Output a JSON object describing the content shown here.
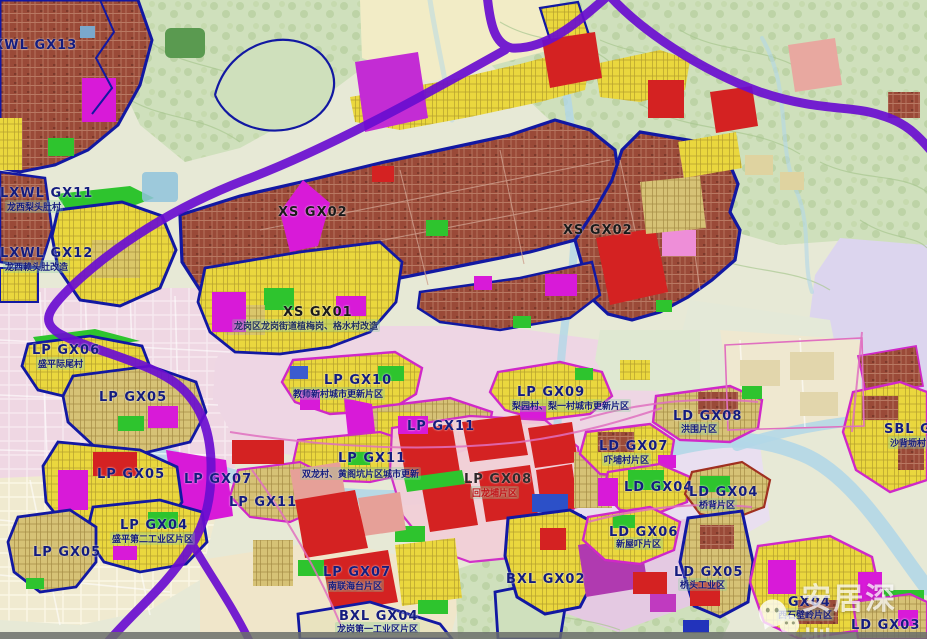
{
  "watermark": {
    "brand": "安居深圳",
    "icon": "wechat-icon"
  },
  "colors": {
    "boundary_purple": "#6a0dd0",
    "boundary_navy": "#1218a2",
    "boundary_magenta": "#d028c8",
    "urban_brown": "#9a4a38",
    "zone_yellow": "#ead73e",
    "zone_khaki": "#d6c276",
    "zone_red": "#d42222",
    "zone_green": "#2ec42e",
    "zone_magenta": "#d81ad8",
    "water_blue": "#b2d7e7",
    "hill_green": "#cfe0bc",
    "label_navy": "#141c7e"
  },
  "labels": [
    {
      "code": "LXWL GX13",
      "x": -16,
      "y": 36
    },
    {
      "code": "LXWL GX11",
      "x": 0,
      "y": 184,
      "sub": "龙西梨头肚村",
      "sx": 5,
      "sy": 200
    },
    {
      "code": "LXWL GX12",
      "x": 0,
      "y": 244,
      "sub": "龙西赖头肚改造",
      "sx": 3,
      "sy": 260
    },
    {
      "code": "XS GX02",
      "x": 278,
      "y": 203,
      "color": "#1a1a1a"
    },
    {
      "code": "XS GX01",
      "x": 283,
      "y": 303,
      "color": "#1a1a1a",
      "sub": "龙岗区龙岗街道植梅岗、格水村改造",
      "sx": 232,
      "sy": 319,
      "subColor": "#203060"
    },
    {
      "code": "XS GX02",
      "x": 563,
      "y": 221,
      "color": "#1a1a1a"
    },
    {
      "code": "LP GX06",
      "x": 32,
      "y": 341,
      "sub": "盛平际尾村",
      "sx": 36,
      "sy": 357
    },
    {
      "code": "LP GX05",
      "x": 99,
      "y": 388
    },
    {
      "code": "LP GX05",
      "x": 97,
      "y": 465
    },
    {
      "code": "LP GX04",
      "x": 120,
      "y": 516,
      "sub": "盛平第二工业区片区",
      "sx": 110,
      "sy": 532
    },
    {
      "code": "LP GX05",
      "x": 33,
      "y": 543
    },
    {
      "code": "LP GX10",
      "x": 324,
      "y": 371,
      "sub": "教师新村城市更新片区",
      "sx": 291,
      "sy": 387
    },
    {
      "code": "LP GX09",
      "x": 517,
      "y": 383,
      "sub": "梨园村、梨一村城市更新片区",
      "sx": 510,
      "sy": 399
    },
    {
      "code": "LP GX11",
      "x": 407,
      "y": 417
    },
    {
      "code": "LP GX11",
      "x": 338,
      "y": 449,
      "sub": "双龙村、黄阁坑片区城市更新",
      "sx": 300,
      "sy": 467
    },
    {
      "code": "LP GX07",
      "x": 184,
      "y": 470
    },
    {
      "code": "LP GX11",
      "x": 229,
      "y": 493
    },
    {
      "code": "LP GX08",
      "x": 464,
      "y": 470,
      "color": "#30282a",
      "sub": "回龙埔片区",
      "sx": 470,
      "sy": 486,
      "subColor": "#c01418"
    },
    {
      "code": "LP GX07",
      "x": 323,
      "y": 563,
      "sub": "南联海台片区",
      "sx": 326,
      "sy": 579
    },
    {
      "code": "BXL GX04",
      "x": 339,
      "y": 607,
      "sub": "龙岗第一工业区片区",
      "sx": 335,
      "sy": 622
    },
    {
      "code": "BXL GX02",
      "x": 506,
      "y": 570
    },
    {
      "code": "LD GX08",
      "x": 673,
      "y": 407,
      "sub": "洪围片区",
      "sx": 679,
      "sy": 422
    },
    {
      "code": "LD GX07",
      "x": 599,
      "y": 437,
      "sub": "吓埔村片区",
      "sx": 602,
      "sy": 453
    },
    {
      "code": "LD GX04",
      "x": 624,
      "y": 478
    },
    {
      "code": "LD GX04",
      "x": 689,
      "y": 483,
      "sub": "桥背片区",
      "sx": 697,
      "sy": 498
    },
    {
      "code": "LD GX06",
      "x": 609,
      "y": 523,
      "sub": "新屋吓片区",
      "sx": 614,
      "sy": 537
    },
    {
      "code": "LD GX05",
      "x": 674,
      "y": 563,
      "sub": "桥头工业区",
      "sx": 678,
      "sy": 578
    },
    {
      "code": "SBL GX08",
      "x": 884,
      "y": 420,
      "sub": "沙背坜村",
      "sx": 888,
      "sy": 436
    },
    {
      "code": "GX04",
      "x": 788,
      "y": 593,
      "sub": "西石壁岭片区",
      "sx": 776,
      "sy": 608
    },
    {
      "code": "LD GX03",
      "x": 851,
      "y": 616
    }
  ]
}
